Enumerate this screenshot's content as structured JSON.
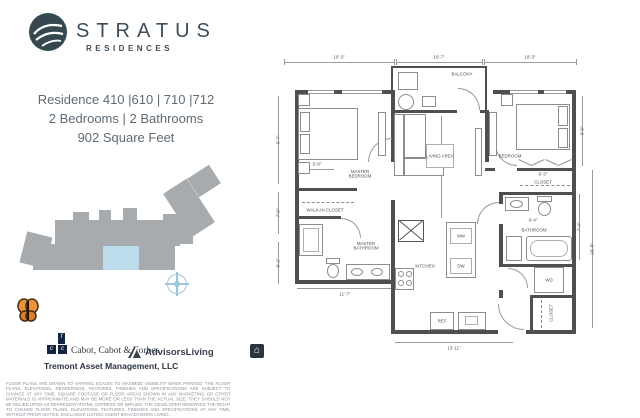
{
  "brand": {
    "name": "STRATUS",
    "sub": "RESIDENCES"
  },
  "residence": {
    "line1": "Residence 410 |610 | 710 |712",
    "line2": "2 Bedrooms | 2 Bathrooms",
    "line3": "902 Square Feet"
  },
  "partners": {
    "ccf": "Cabot, Cabot & Forbes",
    "ccf_mono1": "c",
    "ccf_mono2": "c",
    "ccf_mono3": "f",
    "tremont": "Tremont Asset Management, LLC",
    "advisors": "AdvisorsLiving",
    "eho_glyph": "⌂"
  },
  "disclaimer": "FLOOR PLANS ARE DRAWN TO VARYING SCALES TO MAXIMIZE VISIBILITY WHEN PRINTED. THE FLOOR PLANS, ELEVATIONS, RENDERINGS, FEATURES, FINISHES AND SPECIFICATIONS ARE SUBJECT TO CHANGE AT ANY TIME. SQUARE FOOTAGE OR FLOOR AREAS SHOWN IN ANY MARKETING OR OTHER MATERIALS IS APPROXIMATE AND MAY BE MORE OR LESS THAN THE ACTUAL SIZE. THEY SHOULD NOT BE RELIED UPON AS REPRESENTATIONS, EXPRESS OR IMPLIED. THE DEVELOPER RESERVES THE RIGHT TO CHANGE FLOOR PLANS, ELEVATIONS, FEATURES, FINISHES AND SPECIFICATIONS AT ANY TIME, WITHOUT PRIOR NOTICE. EXCLUSIVE LISTING AGENT BRA/ADVISORS LIVING.",
  "floorplan": {
    "rooms": {
      "master_bedroom": "MASTER BEDROOM",
      "living_area": "LIVING AREA",
      "balcony": "BALCONY",
      "bedroom": "BEDROOM",
      "closet": "CLOSET",
      "bathroom": "BATHROOM",
      "walk_in_closet": "WALK-IN CLOSET",
      "master_bathroom": "MASTER BATHROOM",
      "kitchen": "KITCHEN",
      "coat_closet": "CLOSET"
    },
    "appliances": {
      "mw": "MW",
      "dw": "DW",
      "ref": "REF",
      "wd": "WD"
    },
    "dims": {
      "top_left": "10'-3\"",
      "top_mid": "10'-7\"",
      "top_right": "10'-3\"",
      "left_master": "9'-7\"",
      "left_wic": "7'-6\"",
      "left_mbath": "6'-2\"",
      "bed": "5'-8\"",
      "living": "9'-10\"",
      "bedroom_h": "9'-8\"",
      "closet_w": "6'-3\"",
      "bath_w": "6'-4\"",
      "bath_h": "7'-4\"",
      "right_outer": "15'-8\"",
      "mbath_w": "11'-7\"",
      "kitchen_w": "13'-11\""
    }
  },
  "colors": {
    "brand": "#3e4d59",
    "highlight": "#bcdcec",
    "block": "#a7abad",
    "wall": "#4f4f4f"
  }
}
